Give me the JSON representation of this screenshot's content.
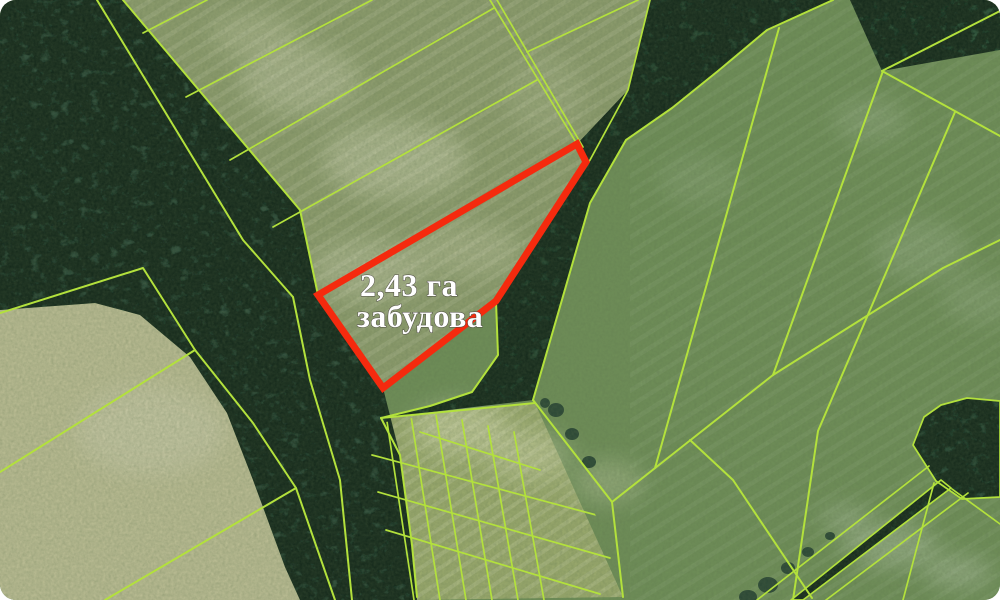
{
  "map": {
    "annotation": {
      "line1": "2,43 га",
      "line2": "забудова"
    },
    "highlight_parcel": {
      "points": "318,295 577,144 586,162 496,301 383,388",
      "area_ha": "2,43",
      "area_unit": "га",
      "land_use_label": "забудова"
    },
    "colors": {
      "parcel_line": "#b3e13c",
      "highlight_stroke": "#f52a0e",
      "label_text": "#ffffff"
    }
  }
}
